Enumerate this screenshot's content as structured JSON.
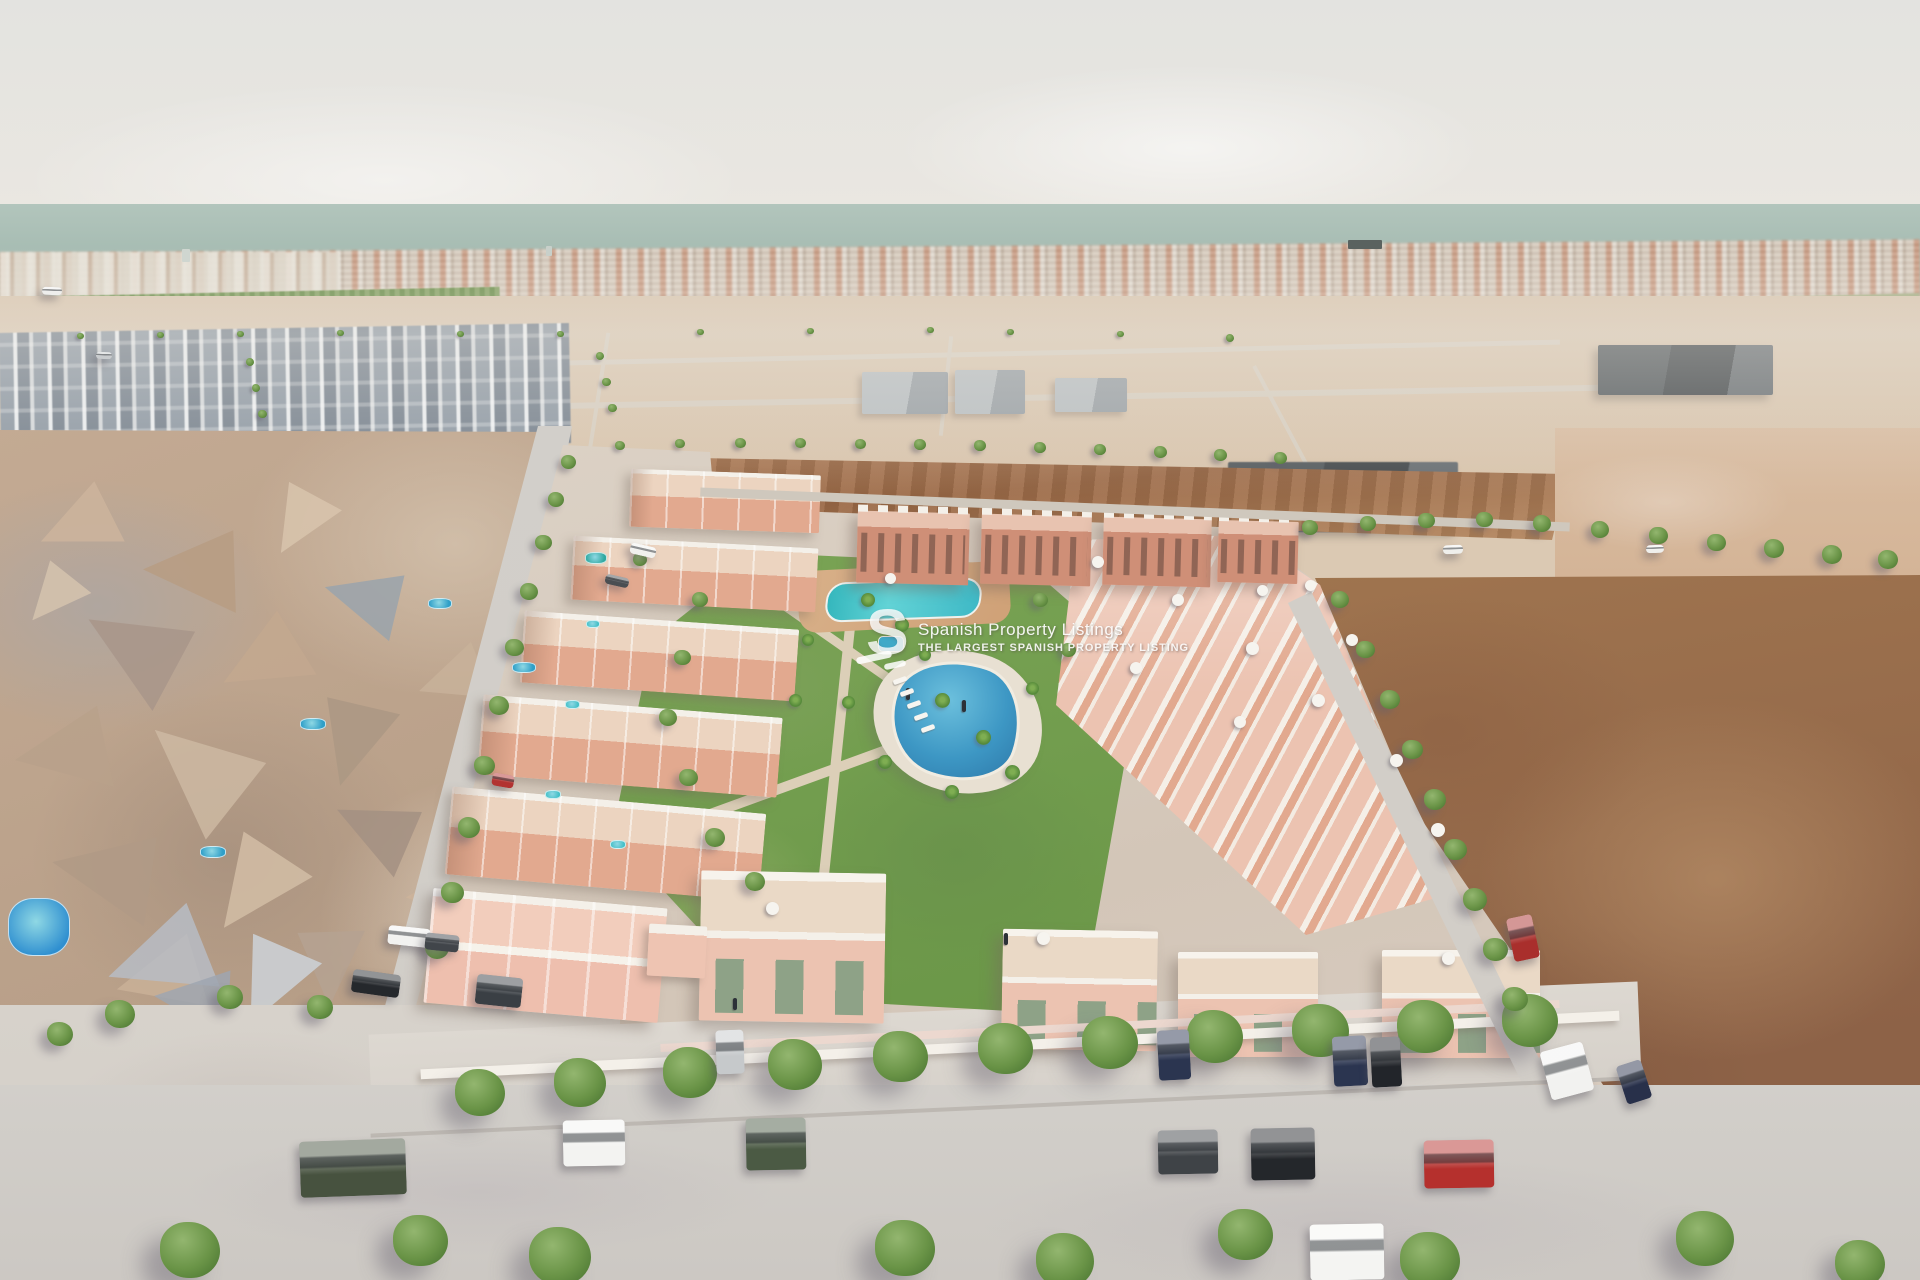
{
  "watermark": {
    "logo_letter": "S",
    "title": "Spanish Property Listings",
    "subtitle": "THE LARGEST SPANISH PROPERTY LISTING"
  },
  "scene": {
    "palette": {
      "sky1": "#e3e3e0",
      "sky2": "#eae7e1",
      "sea1": "#b2c5bc",
      "sea2": "#a0b7ad",
      "town1": "#cfc5b8",
      "town2": "#d7cabb",
      "orch1": "#6f9150",
      "orch2": "#89a468",
      "fieldg1": "#91a76c",
      "fieldg2": "#adb583",
      "sand1": "#dbc9b3",
      "sand2": "#d9c5ad",
      "dirt1": "#a8754f",
      "dirt3": "#b4875f",
      "dirtR1": "#a0754f",
      "dirtR2": "#8d6247",
      "rock1": "#c3aa93",
      "rock2": "#b59c85",
      "bluegray1": "#8e99a4",
      "bluegray2": "#77828e",
      "ind1": "#474c4f",
      "pad1": "#dcd2c6",
      "pad2": "#d3c6b8",
      "lawn1": "#7aa455",
      "lawn2": "#6a9647",
      "salmon1": "#e2a98f",
      "salmon2": "#ecc3b1",
      "salmon3": "#cf8f77",
      "trim": "#f4f0e9",
      "pool1": "#3d97c4",
      "pool2": "#2d77a8",
      "lagoon1": "#35b7bd",
      "lagoon2": "#3fb9c6",
      "road1": "#d2cfca",
      "road2": "#d1cdc7",
      "walk1": "#ddd8d1",
      "tree1": "#6a9447",
      "tree2": "#4f7a35"
    },
    "trees": [
      [
        568,
        462,
        15
      ],
      [
        556,
        500,
        16
      ],
      [
        543,
        543,
        17
      ],
      [
        529,
        592,
        18
      ],
      [
        514,
        648,
        19
      ],
      [
        499,
        706,
        20
      ],
      [
        484,
        766,
        21
      ],
      [
        469,
        828,
        22
      ],
      [
        452,
        893,
        23
      ],
      [
        437,
        948,
        24
      ],
      [
        480,
        1094,
        50
      ],
      [
        580,
        1084,
        52
      ],
      [
        690,
        1074,
        54
      ],
      [
        795,
        1066,
        54
      ],
      [
        900,
        1058,
        55
      ],
      [
        1005,
        1050,
        55
      ],
      [
        1110,
        1044,
        56
      ],
      [
        1215,
        1038,
        56
      ],
      [
        1320,
        1032,
        57
      ],
      [
        1425,
        1028,
        57
      ],
      [
        1530,
        1022,
        56
      ],
      [
        190,
        1252,
        60
      ],
      [
        420,
        1242,
        55
      ],
      [
        560,
        1258,
        62
      ],
      [
        905,
        1250,
        60
      ],
      [
        1065,
        1262,
        58
      ],
      [
        1245,
        1236,
        55
      ],
      [
        1430,
        1262,
        60
      ],
      [
        1705,
        1240,
        58
      ],
      [
        1860,
        1265,
        50
      ],
      [
        1310,
        528,
        16
      ],
      [
        1368,
        524,
        16
      ],
      [
        1426,
        521,
        17
      ],
      [
        1484,
        520,
        17
      ],
      [
        1542,
        524,
        18
      ],
      [
        1600,
        530,
        18
      ],
      [
        1658,
        536,
        19
      ],
      [
        1716,
        543,
        19
      ],
      [
        1774,
        549,
        20
      ],
      [
        1832,
        555,
        20
      ],
      [
        1888,
        560,
        20
      ],
      [
        1340,
        600,
        18
      ],
      [
        1365,
        650,
        19
      ],
      [
        1390,
        700,
        20
      ],
      [
        1412,
        750,
        21
      ],
      [
        1435,
        800,
        22
      ],
      [
        1455,
        850,
        23
      ],
      [
        1475,
        900,
        24
      ],
      [
        1495,
        950,
        25
      ],
      [
        1515,
        1000,
        26
      ],
      [
        620,
        446,
        10
      ],
      [
        680,
        444,
        10
      ],
      [
        740,
        443,
        11
      ],
      [
        800,
        443,
        11
      ],
      [
        860,
        444,
        11
      ],
      [
        920,
        445,
        12
      ],
      [
        980,
        446,
        12
      ],
      [
        1040,
        448,
        12
      ],
      [
        1100,
        450,
        12
      ],
      [
        1160,
        452,
        13
      ],
      [
        1220,
        455,
        13
      ],
      [
        1280,
        458,
        13
      ],
      [
        250,
        362,
        8
      ],
      [
        256,
        388,
        8
      ],
      [
        262,
        414,
        9
      ],
      [
        600,
        356,
        8
      ],
      [
        606,
        382,
        9
      ],
      [
        612,
        408,
        9
      ],
      [
        80,
        336,
        7
      ],
      [
        160,
        335,
        7
      ],
      [
        240,
        334,
        7
      ],
      [
        340,
        333,
        7
      ],
      [
        460,
        334,
        7
      ],
      [
        560,
        334,
        7
      ],
      [
        700,
        332,
        7
      ],
      [
        810,
        331,
        7
      ],
      [
        930,
        330,
        7
      ],
      [
        1010,
        332,
        7
      ],
      [
        1120,
        334,
        7
      ],
      [
        1230,
        338,
        8
      ],
      [
        700,
        600,
        16
      ],
      [
        682,
        658,
        17
      ],
      [
        668,
        718,
        18
      ],
      [
        688,
        778,
        19
      ],
      [
        715,
        838,
        20
      ],
      [
        755,
        882,
        20
      ],
      [
        640,
        560,
        14
      ],
      [
        1040,
        600,
        15
      ],
      [
        1068,
        650,
        15
      ],
      [
        320,
        1008,
        26
      ],
      [
        120,
        1015,
        30
      ],
      [
        230,
        998,
        26
      ],
      [
        60,
        1035,
        26
      ]
    ],
    "palms": [
      [
        868,
        600,
        14
      ],
      [
        902,
        625,
        14
      ],
      [
        942,
        700,
        15
      ],
      [
        983,
        737,
        15
      ],
      [
        1012,
        772,
        15
      ],
      [
        952,
        792,
        14
      ],
      [
        885,
        762,
        14
      ],
      [
        848,
        702,
        13
      ],
      [
        1032,
        688,
        13
      ],
      [
        925,
        655,
        12
      ],
      [
        808,
        640,
        12
      ],
      [
        795,
        700,
        13
      ]
    ],
    "cars": [
      [
        630,
        545,
        26,
        11,
        "#f1f1ee",
        13
      ],
      [
        605,
        576,
        24,
        10,
        "#4a4e52",
        13
      ],
      [
        492,
        774,
        22,
        13,
        "#b23331",
        10
      ],
      [
        388,
        927,
        42,
        19,
        "#f2f2f0",
        6
      ],
      [
        425,
        934,
        34,
        17,
        "#41454a",
        6
      ],
      [
        352,
        972,
        48,
        23,
        "#25282c",
        8
      ],
      [
        300,
        1140,
        106,
        56,
        "#47523f",
        -2
      ],
      [
        563,
        1120,
        62,
        46,
        "#f3f3f1",
        -1
      ],
      [
        746,
        1118,
        60,
        52,
        "#4b5a44",
        -1
      ],
      [
        1158,
        1130,
        60,
        44,
        "#3f4347",
        -1
      ],
      [
        1251,
        1128,
        64,
        52,
        "#24272b",
        -1
      ],
      [
        1424,
        1140,
        70,
        48,
        "#b5302d",
        -1
      ],
      [
        1310,
        1224,
        74,
        56,
        "#f4f4f2",
        -1
      ],
      [
        1545,
        1046,
        44,
        50,
        "#f2f2f0",
        -15
      ],
      [
        1333,
        1036,
        34,
        50,
        "#2b3550",
        -3
      ],
      [
        1371,
        1037,
        30,
        50,
        "#22252a",
        -3
      ],
      [
        1158,
        1030,
        32,
        50,
        "#2b3550",
        -3
      ],
      [
        1621,
        1062,
        26,
        40,
        "#28304a",
        -18
      ],
      [
        1510,
        916,
        26,
        44,
        "#a92f2c",
        -12
      ],
      [
        716,
        1030,
        28,
        44,
        "#c6c9cb",
        -2
      ],
      [
        476,
        976,
        46,
        30,
        "#3a3f44",
        6
      ],
      [
        42,
        287,
        20,
        8,
        "#eeeeec",
        2
      ],
      [
        96,
        352,
        16,
        7,
        "#c9ccce",
        2
      ],
      [
        1443,
        545,
        20,
        9,
        "#efefec",
        -2
      ],
      [
        1646,
        545,
        18,
        8,
        "#efefec",
        -2
      ]
    ],
    "ships": [
      [
        1348,
        240,
        34,
        9,
        "#5a625f"
      ],
      [
        182,
        249,
        8,
        13,
        "#cfd6d0"
      ],
      [
        546,
        246,
        6,
        10,
        "#c8d0ca"
      ]
    ],
    "umbrellas": [
      [
        1098,
        562,
        12
      ],
      [
        1178,
        600,
        12
      ],
      [
        1252,
        648,
        13
      ],
      [
        1318,
        700,
        13
      ],
      [
        1240,
        722,
        12
      ],
      [
        1136,
        668,
        12
      ],
      [
        1396,
        760,
        13
      ],
      [
        1438,
        830,
        14
      ],
      [
        890,
        578,
        11
      ],
      [
        1310,
        585,
        11
      ],
      [
        1262,
        590,
        11
      ],
      [
        1352,
        640,
        12
      ],
      [
        772,
        908,
        13
      ],
      [
        1043,
        938,
        13
      ],
      [
        1448,
        958,
        13
      ]
    ],
    "existing_pools": [
      [
        8,
        898,
        62,
        58,
        "#2f8fd0"
      ],
      [
        200,
        846,
        26,
        12,
        "#2f9fc8"
      ],
      [
        300,
        718,
        26,
        12,
        "#2f9fc8"
      ],
      [
        428,
        598,
        24,
        11,
        "#2f9fc8"
      ],
      [
        512,
        662,
        24,
        11,
        "#2f9fc8"
      ],
      [
        585,
        552,
        22,
        12,
        "#2fa8a0"
      ],
      [
        586,
        620,
        14,
        8,
        "#45c0c8"
      ],
      [
        565,
        700,
        15,
        9,
        "#45c0c8"
      ],
      [
        545,
        790,
        16,
        9,
        "#45c0c8"
      ],
      [
        610,
        840,
        16,
        9,
        "#45c0c8"
      ]
    ],
    "facets": [
      [
        40,
        480,
        90,
        15,
        "#cdb49c"
      ],
      [
        150,
        520,
        110,
        40,
        "#b79c83"
      ],
      [
        260,
        480,
        80,
        -20,
        "#d8c4ad"
      ],
      [
        90,
        600,
        120,
        70,
        "#a8958a"
      ],
      [
        220,
        610,
        100,
        10,
        "#c3a88f"
      ],
      [
        330,
        560,
        90,
        55,
        "#9aa3ab"
      ],
      [
        20,
        700,
        110,
        30,
        "#b9a18b"
      ],
      [
        150,
        720,
        130,
        80,
        "#cdb8a2"
      ],
      [
        300,
        690,
        100,
        -35,
        "#ab9884"
      ],
      [
        420,
        640,
        80,
        20,
        "#c8b29a"
      ],
      [
        60,
        820,
        120,
        50,
        "#b09a86"
      ],
      [
        200,
        830,
        110,
        -15,
        "#d2bda6"
      ],
      [
        340,
        790,
        95,
        65,
        "#a39083"
      ],
      [
        440,
        740,
        70,
        -30,
        "#bfa78f"
      ],
      [
        120,
        930,
        100,
        25,
        "#c9b098"
      ],
      [
        280,
        920,
        90,
        -50,
        "#b5a292"
      ],
      [
        410,
        860,
        75,
        35,
        "#ccb49b"
      ],
      [
        20,
        560,
        70,
        -10,
        "#d5c3ae"
      ],
      [
        110,
        900,
        120,
        20,
        "#b7bcc4"
      ],
      [
        220,
        930,
        100,
        -25,
        "#cdd2d8"
      ],
      [
        160,
        960,
        90,
        45,
        "#9fa6b0"
      ]
    ],
    "lines_far": [
      [
        0,
        356,
        1560,
        5,
        -1.2,
        "#d9d0c2"
      ],
      [
        0,
        398,
        1690,
        6,
        -1,
        "#d8cfc1"
      ],
      [
        248,
        328,
        4,
        130,
        12,
        "#d8cfc1"
      ],
      [
        596,
        332,
        4,
        132,
        9,
        "#d8cfc1"
      ],
      [
        944,
        336,
        4,
        100,
        6,
        "#d8cfc1"
      ],
      [
        1292,
        356,
        4,
        170,
        -28,
        "#d8cfc1"
      ]
    ],
    "lines_park": [
      [
        830,
        580,
        10,
        380,
        6,
        "#dccfb8"
      ],
      [
        680,
        760,
        330,
        10,
        -20,
        "#dccfb8"
      ],
      [
        700,
        640,
        280,
        9,
        35,
        "#dccfb8"
      ]
    ],
    "lines_near": [
      [
        700,
        505,
        870,
        9,
        2.3,
        "#cfc8bd"
      ],
      [
        1405,
        570,
        26,
        540,
        -26,
        "#d2cec8"
      ],
      [
        370,
        1105,
        1260,
        4,
        -2.6,
        "#bdb8b2"
      ]
    ],
    "people": [
      [
        733,
        998
      ],
      [
        1004,
        933
      ],
      [
        962,
        700
      ],
      [
        906,
        688
      ]
    ],
    "loungers": [
      [
        893,
        678
      ],
      [
        900,
        690
      ],
      [
        907,
        702
      ],
      [
        914,
        714
      ],
      [
        921,
        726
      ]
    ]
  }
}
